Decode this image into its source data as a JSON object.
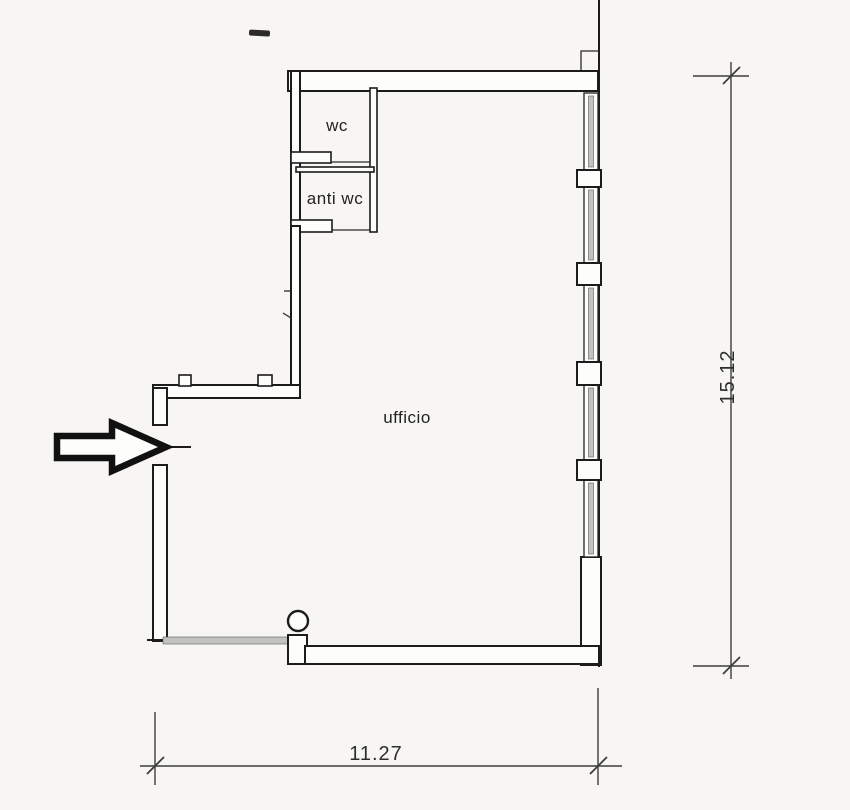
{
  "page": {
    "background": "#f7f6f3",
    "wall_ink": "#1c1c1c",
    "dimension_ink": "#3d3d3d",
    "glazing_gray": "#c2c2c0"
  },
  "rooms": [
    {
      "label": "wc"
    },
    {
      "label": "anti wc"
    },
    {
      "label": "ufficio"
    }
  ],
  "dimensions": {
    "right_total": "15.12",
    "bottom_total": "11.27"
  },
  "icons": [
    {
      "name": "entrance-arrow-icon"
    }
  ]
}
